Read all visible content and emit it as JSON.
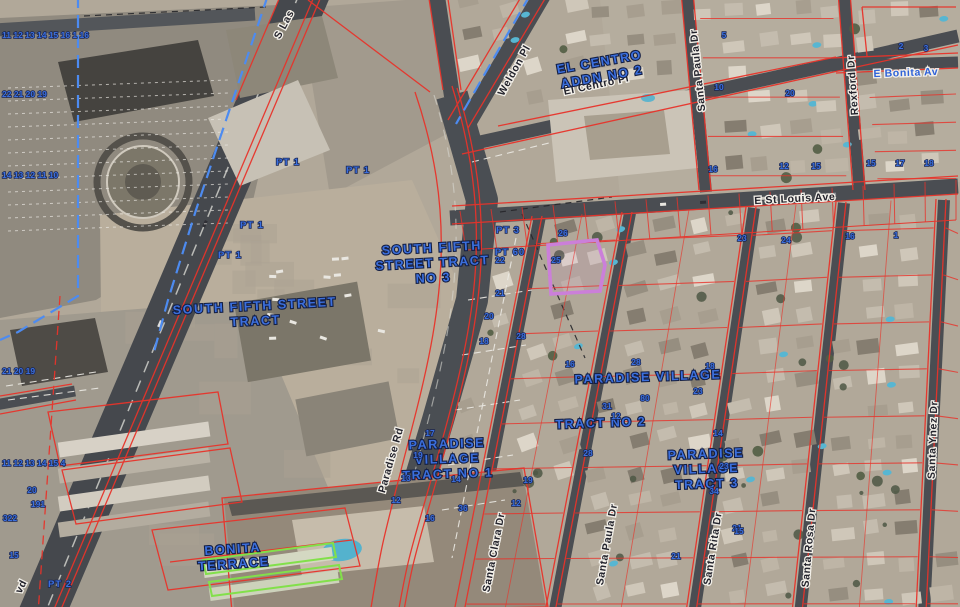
{
  "map": {
    "type": "parcel-aerial-view",
    "colors": {
      "parcel_line": "#e8332a",
      "subdivision_boundary": "#4d8bf0",
      "highlight": "#cb7fd9",
      "green_parcel": "#82e04a",
      "label_blue": "#3b6fdd",
      "street_text": "#23232c"
    },
    "street_labels": [
      {
        "text": "S Las",
        "x": 287,
        "y": 26,
        "rot": -62,
        "style": "dark"
      },
      {
        "text": "Weldon Pl",
        "x": 517,
        "y": 72,
        "rot": -61,
        "style": "dark"
      },
      {
        "text": "El Centro Pl",
        "x": 597,
        "y": 88,
        "rot": -12,
        "style": "dark"
      },
      {
        "text": "Santa Paula Dr",
        "x": 701,
        "y": 70,
        "rot": -96,
        "style": "dark"
      },
      {
        "text": "Rexford Dr",
        "x": 856,
        "y": 85,
        "rot": -94,
        "style": "dark"
      },
      {
        "text": "E Bonita Av",
        "x": 906,
        "y": 76,
        "rot": -2,
        "style": "blue"
      },
      {
        "text": "E St Louis Ave",
        "x": 795,
        "y": 202,
        "rot": -3,
        "style": "dark"
      },
      {
        "text": "Paradise Rd",
        "x": 394,
        "y": 461,
        "rot": -74,
        "style": "dark"
      },
      {
        "text": "Santa Clara Dr",
        "x": 497,
        "y": 553,
        "rot": -79,
        "style": "dark"
      },
      {
        "text": "Santa Paula Dr",
        "x": 610,
        "y": 545,
        "rot": -80,
        "style": "dark"
      },
      {
        "text": "Santa Rita Dr",
        "x": 716,
        "y": 549,
        "rot": -81,
        "style": "dark"
      },
      {
        "text": "Santa Rosa Dr",
        "x": 812,
        "y": 548,
        "rot": -85,
        "style": "dark"
      },
      {
        "text": "Santa Ynez Dr",
        "x": 936,
        "y": 440,
        "rot": -88,
        "style": "dark"
      },
      {
        "text": "vd",
        "x": 24,
        "y": 588,
        "rot": -63,
        "style": "dark"
      }
    ],
    "tract_labels": [
      {
        "lines": [
          "EL CENTRO",
          "ADDN NO 2"
        ],
        "x": 600,
        "y": 66,
        "rot": -10
      },
      {
        "lines": [
          "SOUTH FIFTH",
          "STREET TRACT",
          "NO 3"
        ],
        "x": 432,
        "y": 252,
        "rot": -3
      },
      {
        "lines": [
          "SOUTH FIFTH STREET",
          "TRACT"
        ],
        "x": 255,
        "y": 310,
        "rot": -3
      },
      {
        "lines": [
          "PARADISE  VILLAGE"
        ],
        "x": 648,
        "y": 381,
        "rot": -2
      },
      {
        "lines": [
          "TRACT NO 2"
        ],
        "x": 601,
        "y": 427,
        "rot": -2
      },
      {
        "lines": [
          "PARADISE",
          "VILLAGE",
          "TRACT NO 1"
        ],
        "x": 447,
        "y": 448,
        "rot": -2
      },
      {
        "lines": [
          "PARADISE",
          "VILLAGE",
          "TRACT 3"
        ],
        "x": 706,
        "y": 458,
        "rot": -2
      },
      {
        "lines": [
          "BONITA",
          "TERRACE"
        ],
        "x": 233,
        "y": 553,
        "rot": -4
      }
    ],
    "pt_labels": [
      {
        "t": "PT 1",
        "x": 288,
        "y": 165
      },
      {
        "t": "PT 1",
        "x": 358,
        "y": 173
      },
      {
        "t": "PT 1",
        "x": 252,
        "y": 228
      },
      {
        "t": "PT 1",
        "x": 230,
        "y": 258
      },
      {
        "t": "PT 3",
        "x": 508,
        "y": 233
      },
      {
        "t": "PT 60",
        "x": 510,
        "y": 255
      },
      {
        "t": "PT 2",
        "x": 60,
        "y": 587
      }
    ],
    "lot_numbers": [
      {
        "t": "11 12 13 14 15 16 1 16",
        "x": 2,
        "y": 38
      },
      {
        "t": "22 21 20 19",
        "x": 2,
        "y": 97
      },
      {
        "t": "14 13 12 11 10",
        "x": 2,
        "y": 178
      },
      {
        "t": "21 20 19",
        "x": 2,
        "y": 374
      },
      {
        "t": "11 12 13 14 15 4",
        "x": 2,
        "y": 466
      },
      {
        "t": "20",
        "x": 32,
        "y": 493
      },
      {
        "t": "191",
        "x": 38,
        "y": 507
      },
      {
        "t": "322",
        "x": 10,
        "y": 521
      },
      {
        "t": "15",
        "x": 14,
        "y": 558
      },
      {
        "t": "5",
        "x": 724,
        "y": 38
      },
      {
        "t": "2",
        "x": 901,
        "y": 49
      },
      {
        "t": "3",
        "x": 926,
        "y": 51
      },
      {
        "t": "10",
        "x": 719,
        "y": 90
      },
      {
        "t": "20",
        "x": 790,
        "y": 96
      },
      {
        "t": "16",
        "x": 713,
        "y": 172
      },
      {
        "t": "12",
        "x": 784,
        "y": 169
      },
      {
        "t": "15",
        "x": 816,
        "y": 169
      },
      {
        "t": "15",
        "x": 871,
        "y": 166
      },
      {
        "t": "17",
        "x": 900,
        "y": 166
      },
      {
        "t": "18",
        "x": 929,
        "y": 166
      },
      {
        "t": "23",
        "x": 742,
        "y": 241
      },
      {
        "t": "24",
        "x": 786,
        "y": 243
      },
      {
        "t": "16",
        "x": 850,
        "y": 239
      },
      {
        "t": "1",
        "x": 896,
        "y": 238
      },
      {
        "t": "26",
        "x": 563,
        "y": 236
      },
      {
        "t": "22",
        "x": 500,
        "y": 263
      },
      {
        "t": "25",
        "x": 556,
        "y": 263
      },
      {
        "t": "21",
        "x": 500,
        "y": 296
      },
      {
        "t": "20",
        "x": 489,
        "y": 319
      },
      {
        "t": "28",
        "x": 521,
        "y": 339
      },
      {
        "t": "18",
        "x": 484,
        "y": 344
      },
      {
        "t": "16",
        "x": 570,
        "y": 367
      },
      {
        "t": "28",
        "x": 636,
        "y": 365
      },
      {
        "t": "31",
        "x": 607,
        "y": 409
      },
      {
        "t": "80",
        "x": 645,
        "y": 401
      },
      {
        "t": "12",
        "x": 616,
        "y": 419
      },
      {
        "t": "28",
        "x": 588,
        "y": 456
      },
      {
        "t": "18",
        "x": 710,
        "y": 369
      },
      {
        "t": "23",
        "x": 698,
        "y": 394
      },
      {
        "t": "14",
        "x": 718,
        "y": 436
      },
      {
        "t": "23",
        "x": 724,
        "y": 469
      },
      {
        "t": "34",
        "x": 714,
        "y": 494
      },
      {
        "t": "21",
        "x": 737,
        "y": 531
      },
      {
        "t": "17",
        "x": 430,
        "y": 436
      },
      {
        "t": "19",
        "x": 418,
        "y": 458
      },
      {
        "t": "13",
        "x": 406,
        "y": 481
      },
      {
        "t": "14",
        "x": 456,
        "y": 482
      },
      {
        "t": "12",
        "x": 396,
        "y": 503
      },
      {
        "t": "36",
        "x": 463,
        "y": 511
      },
      {
        "t": "19",
        "x": 528,
        "y": 483
      },
      {
        "t": "12",
        "x": 516,
        "y": 506
      },
      {
        "t": "16",
        "x": 430,
        "y": 521
      },
      {
        "t": "15",
        "x": 739,
        "y": 534
      },
      {
        "t": "21",
        "x": 676,
        "y": 559
      }
    ],
    "highlight_parcel": {
      "points": "548,245 597,240 605,265 600,291 551,294"
    },
    "green_parcels": [
      "203,560 333,543 336,557 206,574",
      "209,582 339,565 342,579 212,596"
    ]
  }
}
